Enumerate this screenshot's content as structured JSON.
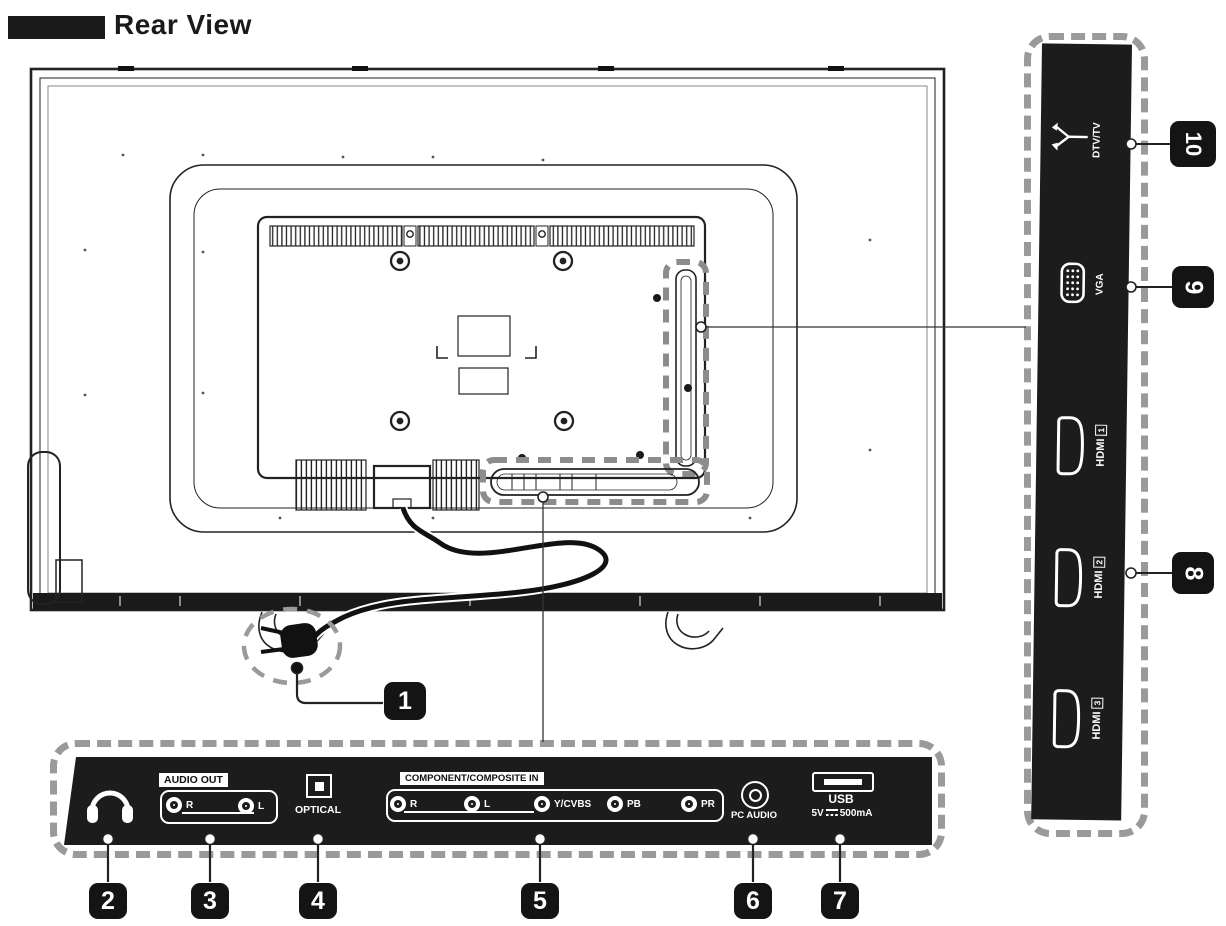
{
  "header": {
    "title": "Rear View"
  },
  "colors": {
    "ink": "#1a1a1a",
    "panel": "#1c1c1c",
    "dash": "#9a9a9a"
  },
  "bottom_panel": {
    "audio_out": {
      "label": "AUDIO OUT",
      "jacks": [
        {
          "label": "R"
        },
        {
          "label": "L"
        }
      ]
    },
    "optical": {
      "label": "OPTICAL"
    },
    "component": {
      "label": "COMPONENT/COMPOSITE IN",
      "jacks": [
        {
          "label": "R"
        },
        {
          "label": "L"
        },
        {
          "label": "Y/CVBS"
        },
        {
          "label": "PB"
        },
        {
          "label": "PR"
        }
      ]
    },
    "pc_audio": {
      "label": "PC  AUDIO"
    },
    "usb": {
      "label": "USB",
      "volt": "5V",
      "current": "500mA"
    }
  },
  "side_panel": {
    "dtv": {
      "label": "DTV/TV"
    },
    "vga": {
      "label": "VGA"
    },
    "hdmi1": {
      "label": "HDMI",
      "num": "1"
    },
    "hdmi2": {
      "label": "HDMI",
      "num": "2"
    },
    "hdmi3": {
      "label": "HDMI",
      "num": "3"
    }
  },
  "callouts": {
    "c1": "1",
    "c2": "2",
    "c3": "3",
    "c4": "4",
    "c5": "5",
    "c6": "6",
    "c7": "7",
    "c8": "8",
    "c9": "9",
    "c10": "10"
  }
}
